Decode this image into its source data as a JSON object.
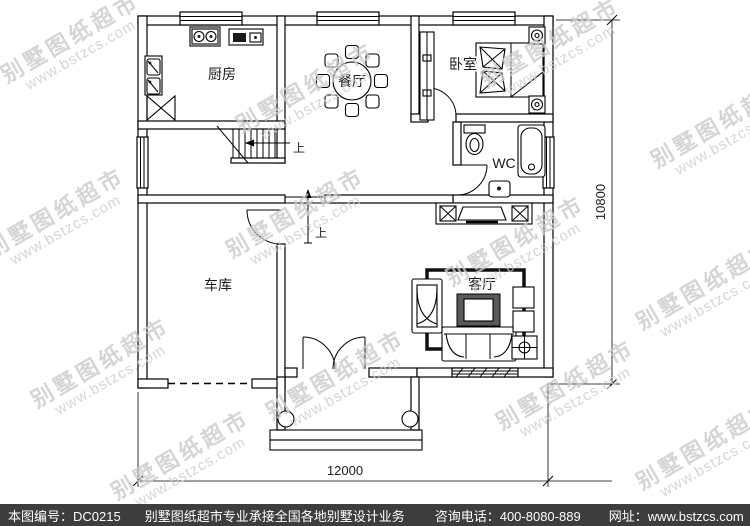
{
  "watermark": {
    "line1": "别墅图纸超市",
    "line2": "www.bstzcs.com"
  },
  "rooms": {
    "kitchen": "厨房",
    "dining": "餐厅",
    "bedroom": "卧室",
    "wc": "WC",
    "garage": "车库",
    "living": "客厅"
  },
  "stairs": {
    "up": "上"
  },
  "dimensions": {
    "width": "12000",
    "height": "10800"
  },
  "footer": {
    "plan_id": "本图编号：DC0215",
    "service": "别墅图纸超市专业承接全国各地别墅设计业务",
    "phone": "咨询电话：400-8080-889",
    "website": "网址：www.bstzcs.com"
  },
  "colors": {
    "line": "#000000",
    "watermark": "#cbcbcb",
    "footer_bg": "#3d3d3d",
    "footer_text": "#ffffff"
  }
}
